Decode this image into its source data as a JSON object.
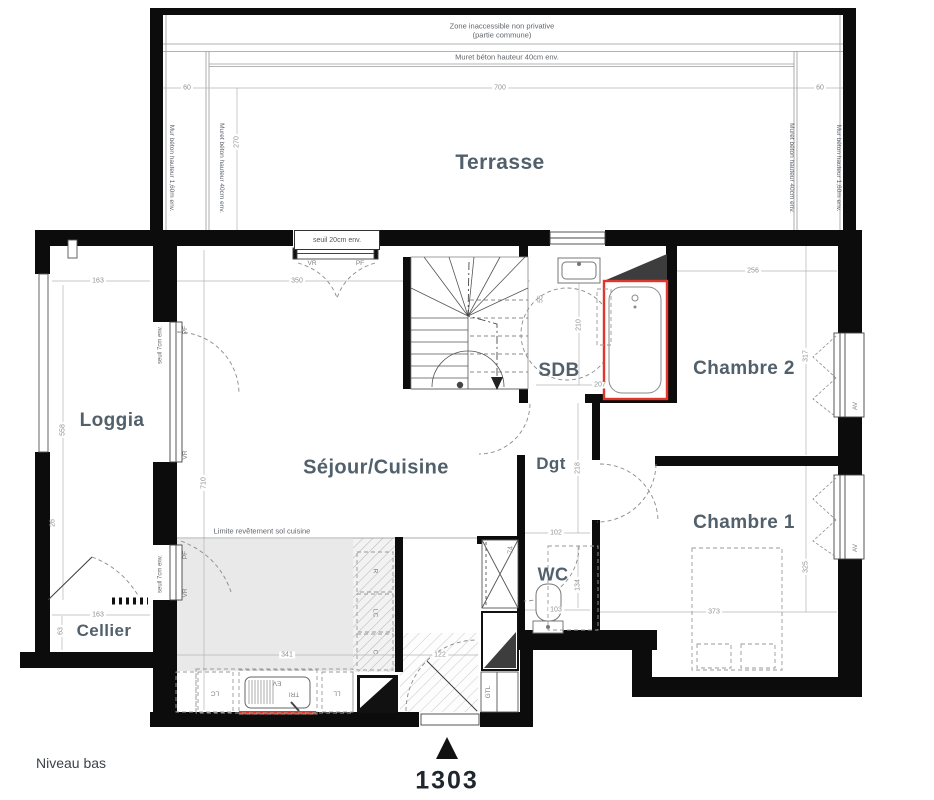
{
  "title": {
    "level": "Niveau bas",
    "unit": "1303"
  },
  "rooms": {
    "terrasse": "Terrasse",
    "loggia": "Loggia",
    "sejour_cuisine": "Séjour/Cuisine",
    "sdb": "SDB",
    "chambre2": "Chambre 2",
    "chambre1": "Chambre 1",
    "dgt": "Dgt",
    "wc": "WC",
    "cellier": "Cellier"
  },
  "annotations": {
    "zone1": "Zone inaccessible non privative",
    "zone2": "(partie commune)",
    "muret_top": "Muret béton hauteur 40cm env.",
    "mur_left": "Mur béton hauteur 1,60m env.",
    "muret_left": "Muret béton hauteur 40cm env.",
    "muret_right": "Muret béton hauteur 40cm env.",
    "mur_right": "Mur béton hauteur 1,60m env.",
    "seuil_entree": "seuil 20cm env.",
    "seuil_loggia": "seuil 7cm env.",
    "seuil_cellier": "seuil 7cm env.",
    "limite": "Limite revêtement sol cuisine"
  },
  "codes": {
    "vr": "VR",
    "pf": "PF",
    "av": "AV",
    "gtl": "GTL",
    "ev": "EV",
    "tri": "TRI",
    "ll": "LL",
    "lc": "LC",
    "r": "R",
    "c": "C"
  },
  "dims": {
    "terrace_width": "700",
    "left_60": "60",
    "right_60": "60",
    "left_270": "270",
    "entry": "350",
    "loggia_w": "163",
    "loggia_h": "558",
    "loggia_wall": "26",
    "cellier_w": "163",
    "cellier_h": "63",
    "sejour_h": "710",
    "sdb_side": "55",
    "sdb_h": "210",
    "sdb_w": "207",
    "ch2_w": "256",
    "ch2_h": "317",
    "ch1_w": "373",
    "ch1_h": "325",
    "dgt_h": "218",
    "dgt_w": "102",
    "wc_h": "134",
    "wc_w": "103",
    "shaft": "74",
    "kitchen_w": "341",
    "entry_w": "122"
  },
  "colors": {
    "wall": "#0c0c0c",
    "accent_red": "#e2362b",
    "label": "#52606b",
    "kitchen_floor": "#e9e9e9"
  }
}
